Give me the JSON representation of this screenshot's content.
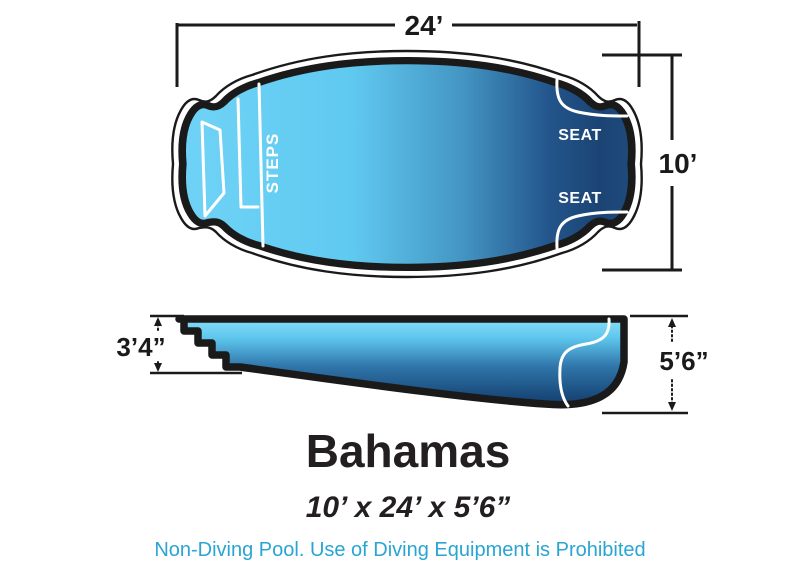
{
  "diagram": {
    "top_view": {
      "length_label": "24’",
      "width_label": "10’",
      "steps_label": "STEPS",
      "seat_top_label": "SEAT",
      "seat_bottom_label": "SEAT"
    },
    "side_view": {
      "shallow_depth_label": "3’4”",
      "deep_depth_label": "5’6”"
    },
    "title": "Bahamas",
    "dimensions_summary": "10’ x 24’ x 5’6”",
    "disclaimer": "Non-Diving Pool. Use of Diving Equipment is Prohibited",
    "colors": {
      "water_light": "#6fd3f6",
      "water_mid": "#4496c4",
      "water_dark": "#1b4474",
      "outline": "#1a1a1a",
      "title_text": "#231f20",
      "disclaimer_text": "#2aa5d3"
    }
  }
}
